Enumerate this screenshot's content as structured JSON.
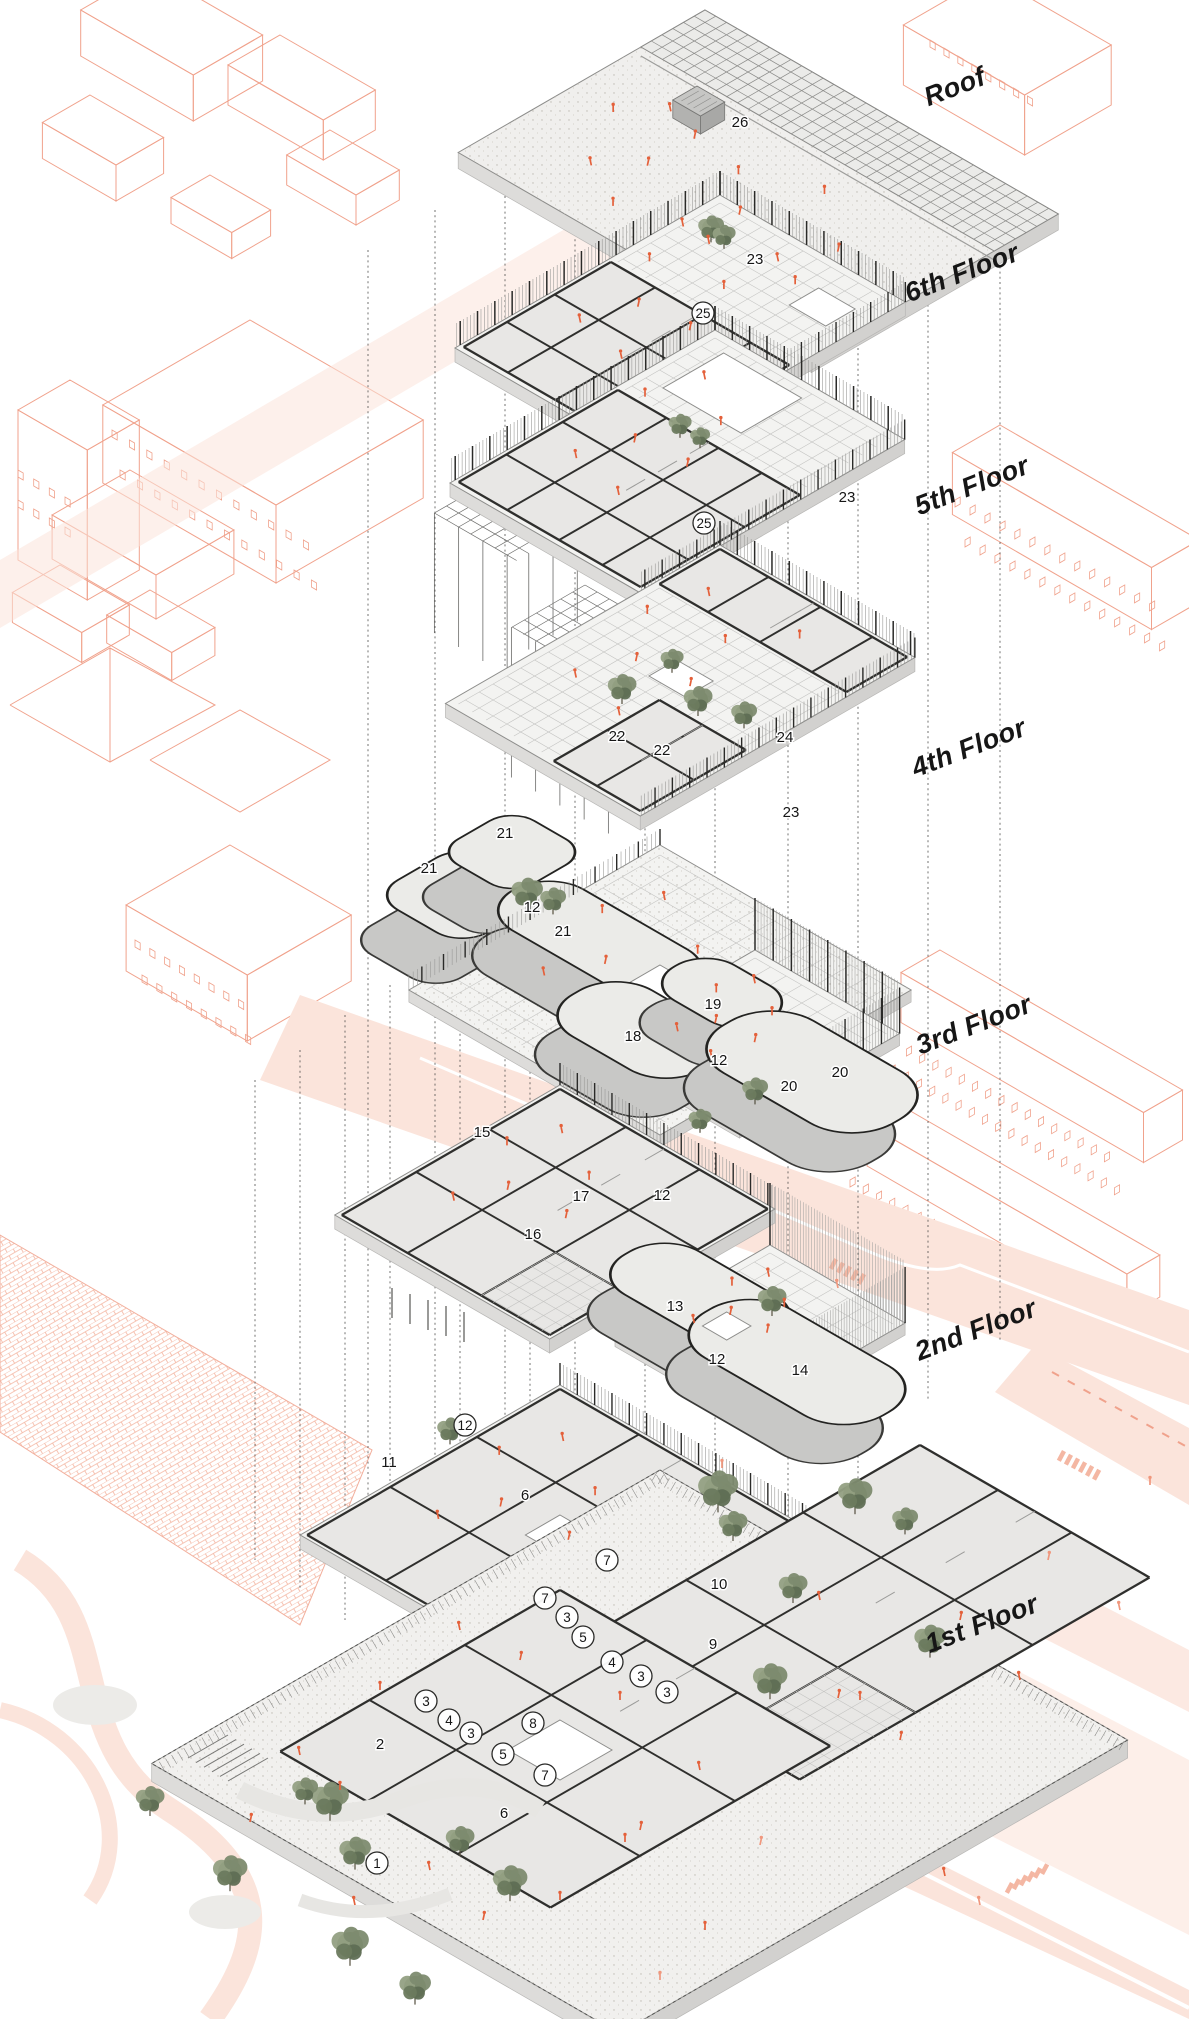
{
  "diagram": {
    "type": "exploded-axonometric-floor-plans",
    "levels": [
      {
        "label": "Roof",
        "label_x": 958,
        "label_y": 95,
        "rooms": [
          {
            "n": "26",
            "x": 740,
            "y": 122,
            "circled": false
          }
        ]
      },
      {
        "label": "6th Floor",
        "label_x": 965,
        "label_y": 281,
        "rooms": [
          {
            "n": "23",
            "x": 755,
            "y": 259,
            "circled": false
          },
          {
            "n": "25",
            "x": 703,
            "y": 313,
            "circled": true
          }
        ]
      },
      {
        "label": "5th Floor",
        "label_x": 975,
        "label_y": 494,
        "rooms": [
          {
            "n": "23",
            "x": 847,
            "y": 497,
            "circled": false
          },
          {
            "n": "25",
            "x": 704,
            "y": 523,
            "circled": true
          }
        ]
      },
      {
        "label": "4th Floor",
        "label_x": 972,
        "label_y": 756,
        "rooms": [
          {
            "n": "22",
            "x": 617,
            "y": 736,
            "circled": false
          },
          {
            "n": "22",
            "x": 662,
            "y": 750,
            "circled": false
          },
          {
            "n": "24",
            "x": 785,
            "y": 737,
            "circled": false
          },
          {
            "n": "23",
            "x": 791,
            "y": 812,
            "circled": false
          }
        ]
      },
      {
        "label": "3rd Floor",
        "label_x": 977,
        "label_y": 1033,
        "rooms": [
          {
            "n": "21",
            "x": 505,
            "y": 833,
            "circled": false
          },
          {
            "n": "21",
            "x": 429,
            "y": 868,
            "circled": false
          },
          {
            "n": "12",
            "x": 532,
            "y": 907,
            "circled": false
          },
          {
            "n": "21",
            "x": 563,
            "y": 931,
            "circled": false
          },
          {
            "n": "19",
            "x": 713,
            "y": 1004,
            "circled": false
          },
          {
            "n": "18",
            "x": 633,
            "y": 1036,
            "circled": false
          },
          {
            "n": "12",
            "x": 719,
            "y": 1060,
            "circled": false
          },
          {
            "n": "20",
            "x": 840,
            "y": 1072,
            "circled": false
          },
          {
            "n": "20",
            "x": 789,
            "y": 1086,
            "circled": false
          }
        ]
      },
      {
        "label": "2nd Floor",
        "label_x": 979,
        "label_y": 1338,
        "rooms": [
          {
            "n": "15",
            "x": 482,
            "y": 1132,
            "circled": false
          },
          {
            "n": "17",
            "x": 581,
            "y": 1196,
            "circled": false
          },
          {
            "n": "12",
            "x": 662,
            "y": 1195,
            "circled": false
          },
          {
            "n": "16",
            "x": 533,
            "y": 1234,
            "circled": false
          },
          {
            "n": "13",
            "x": 675,
            "y": 1306,
            "circled": false
          },
          {
            "n": "12",
            "x": 717,
            "y": 1359,
            "circled": false
          },
          {
            "n": "14",
            "x": 800,
            "y": 1370,
            "circled": false
          }
        ]
      },
      {
        "label": "1st Floor",
        "label_x": 985,
        "label_y": 1632,
        "rooms": [
          {
            "n": "12",
            "x": 465,
            "y": 1425,
            "circled": true
          },
          {
            "n": "11",
            "x": 389,
            "y": 1462,
            "circled": false
          },
          {
            "n": "6",
            "x": 525,
            "y": 1495,
            "circled": false
          },
          {
            "n": "7",
            "x": 607,
            "y": 1560,
            "circled": true
          },
          {
            "n": "10",
            "x": 719,
            "y": 1584,
            "circled": false
          },
          {
            "n": "7",
            "x": 545,
            "y": 1598,
            "circled": true
          },
          {
            "n": "3",
            "x": 567,
            "y": 1617,
            "circled": true
          },
          {
            "n": "5",
            "x": 583,
            "y": 1637,
            "circled": true
          },
          {
            "n": "9",
            "x": 713,
            "y": 1644,
            "circled": false
          },
          {
            "n": "4",
            "x": 612,
            "y": 1662,
            "circled": true
          },
          {
            "n": "3",
            "x": 641,
            "y": 1676,
            "circled": true
          },
          {
            "n": "3",
            "x": 667,
            "y": 1692,
            "circled": true
          },
          {
            "n": "3",
            "x": 426,
            "y": 1701,
            "circled": true
          },
          {
            "n": "4",
            "x": 449,
            "y": 1720,
            "circled": true
          },
          {
            "n": "8",
            "x": 533,
            "y": 1723,
            "circled": true
          },
          {
            "n": "3",
            "x": 471,
            "y": 1733,
            "circled": true
          },
          {
            "n": "2",
            "x": 380,
            "y": 1744,
            "circled": false
          },
          {
            "n": "5",
            "x": 503,
            "y": 1754,
            "circled": true
          },
          {
            "n": "7",
            "x": 545,
            "y": 1775,
            "circled": true
          },
          {
            "n": "6",
            "x": 504,
            "y": 1813,
            "circled": false
          },
          {
            "n": "1",
            "x": 377,
            "y": 1863,
            "circled": true
          }
        ]
      }
    ],
    "colors": {
      "context_line": "#f0a28c",
      "road_fill": "#fbe4db",
      "people": "#e4603a",
      "people_context": "#f0977d",
      "tree": "#76836a",
      "wall_dark": "#2f2f2d",
      "plate_fill": "#f3f3f1",
      "label_text": "#161616"
    }
  }
}
